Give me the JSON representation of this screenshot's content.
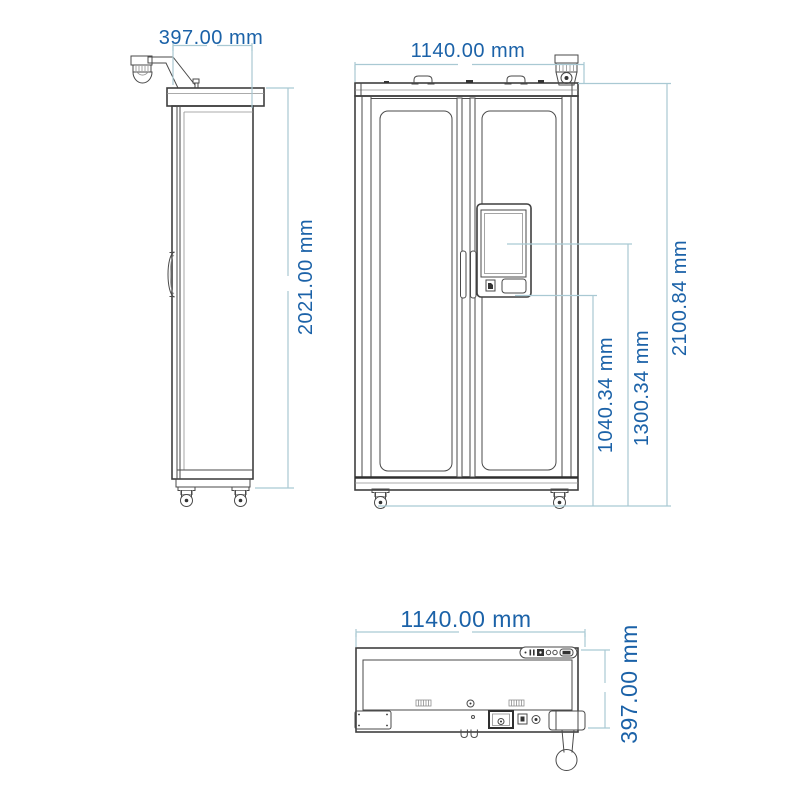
{
  "colors": {
    "dimension_text": "#1b62a8",
    "dimension_line": "#a9c9d3",
    "outline": "#3f3f3f"
  },
  "drawing": {
    "side_view": {
      "depth_label": "397.00 mm",
      "height_label": "2021.00 mm"
    },
    "front_view": {
      "width_label": "1140.00 mm",
      "overall_height_label": "2100.84 mm",
      "screen_center_height_label": "1300.34 mm",
      "panel_bottom_height_label": "1040.34 mm"
    },
    "bottom_view": {
      "width_label": "1140.00 mm",
      "depth_label": "397.00 mm"
    }
  }
}
